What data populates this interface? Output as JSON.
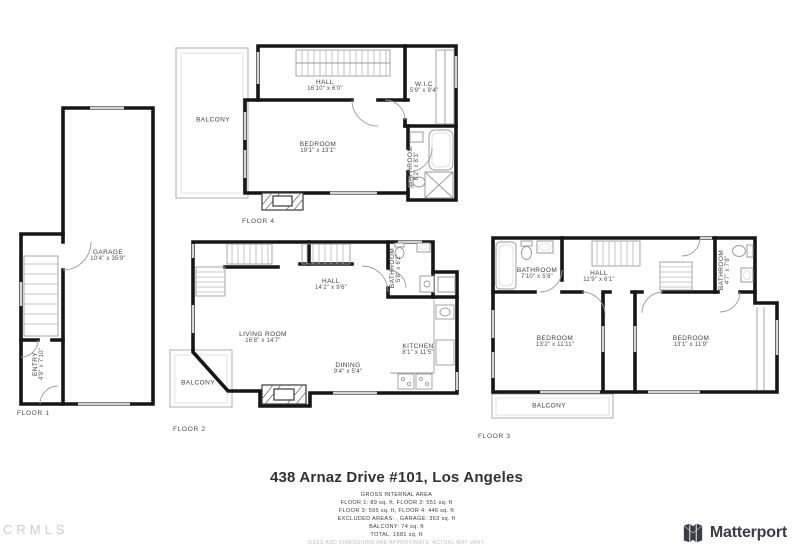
{
  "title": "438 Arnaz Drive #101, Los Angeles",
  "area_summary": {
    "heading": "GROSS INTERNAL AREA",
    "lines": [
      "FLOOR 1: 89 sq. ft, FLOOR 2: 551 sq. ft",
      "FLOOR 3: 595 sq. ft, FLOOR 4: 446 sq. ft",
      "EXCLUDED AREAS: , GARAGE: 363 sq. ft",
      "BALCONY: 74 sq. ft",
      "TOTAL: 1681 sq. ft"
    ],
    "disclaimer": "SIZES AND DIMENSIONS ARE APPROXIMATE, ACTUAL MAY VARY."
  },
  "watermark": "CRMLS",
  "branding": {
    "logo_text": "Matterport"
  },
  "colors": {
    "wall": "#161616",
    "fixture": "#9b9b9b",
    "window": "#d4d4d4",
    "text": "#3f3f3f",
    "brand_text": "#3b3b43"
  },
  "floors": [
    {
      "label": "FLOOR 1",
      "rooms": {
        "garage": {
          "name": "GARAGE",
          "dims": "10'4\" x 35'9\""
        },
        "entry": {
          "name": "ENTRY",
          "dims": "4'9\" x 7'10\""
        }
      }
    },
    {
      "label": "FLOOR 2",
      "rooms": {
        "hall": {
          "name": "HALL",
          "dims": "14'2\" x 9'6\""
        },
        "living": {
          "name": "LIVING ROOM",
          "dims": "16'8\" x 14'7\""
        },
        "dining": {
          "name": "DINING",
          "dims": "9'4\" x 5'4\""
        },
        "kitchen": {
          "name": "KITCHEN",
          "dims": "8'1\" x 11'5\""
        },
        "bathroom": {
          "name": "BATHROOM",
          "dims": "5'8\" x 6'2\""
        },
        "balcony": {
          "name": "BALCONY"
        }
      }
    },
    {
      "label": "FLOOR 3",
      "rooms": {
        "bathroom1": {
          "name": "BATHROOM",
          "dims": "7'10\" x 5'8\""
        },
        "hall": {
          "name": "HALL",
          "dims": "11'9\" x 6'1\""
        },
        "bathroom2": {
          "name": "BATHROOM",
          "dims": "4'7\" x 7'8\""
        },
        "bedroom1": {
          "name": "BEDROOM",
          "dims": "13'2\" x 11'11\""
        },
        "bedroom2": {
          "name": "BEDROOM",
          "dims": "13'1\" x 11'9\""
        },
        "balcony": {
          "name": "BALCONY"
        }
      }
    },
    {
      "label": "FLOOR 4",
      "rooms": {
        "hall": {
          "name": "HALL",
          "dims": "16'10\" x 6'0\""
        },
        "wic": {
          "name": "W.I.C",
          "dims": "5'9\" x 9'4\""
        },
        "bedroom": {
          "name": "BEDROOM",
          "dims": "19'1\" x 13'1\""
        },
        "bathroom": {
          "name": "BATHROOM",
          "dims": "8'2\" x 8'3\""
        },
        "balcony": {
          "name": "BALCONY"
        }
      }
    }
  ]
}
